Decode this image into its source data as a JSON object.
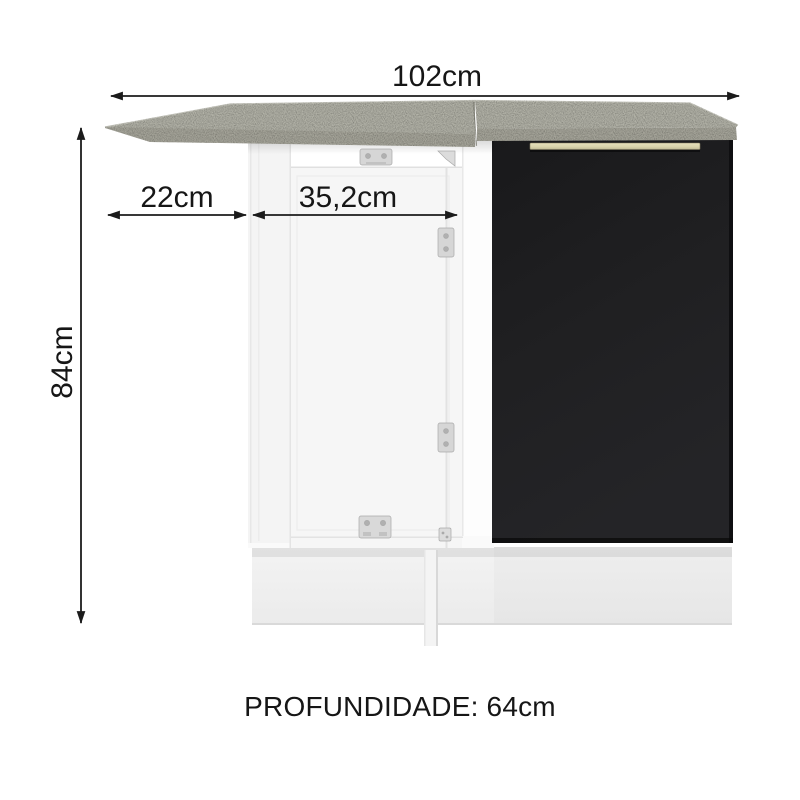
{
  "diagram": {
    "kind": "furniture-dimension-diagram",
    "subject": "corner kitchen base cabinet with countertop",
    "labels": {
      "width": "102cm",
      "left_overhang": "22cm",
      "door_width": "35,2cm",
      "height": "84cm",
      "depth": "PROFUNDIDADE: 64cm"
    },
    "colors": {
      "background": "#ffffff",
      "dimension_text": "#161616",
      "dimension_line": "#1b1b1b",
      "countertop_top": "#b4b4a9",
      "countertop_edge": "#a8a79c",
      "white_cabinet": "#f7f7f7",
      "black_door": "#1d1d1f",
      "handle": "#d8d2ab",
      "plinth": "#efefef",
      "hinge_metal": "#d6d6d6"
    }
  }
}
